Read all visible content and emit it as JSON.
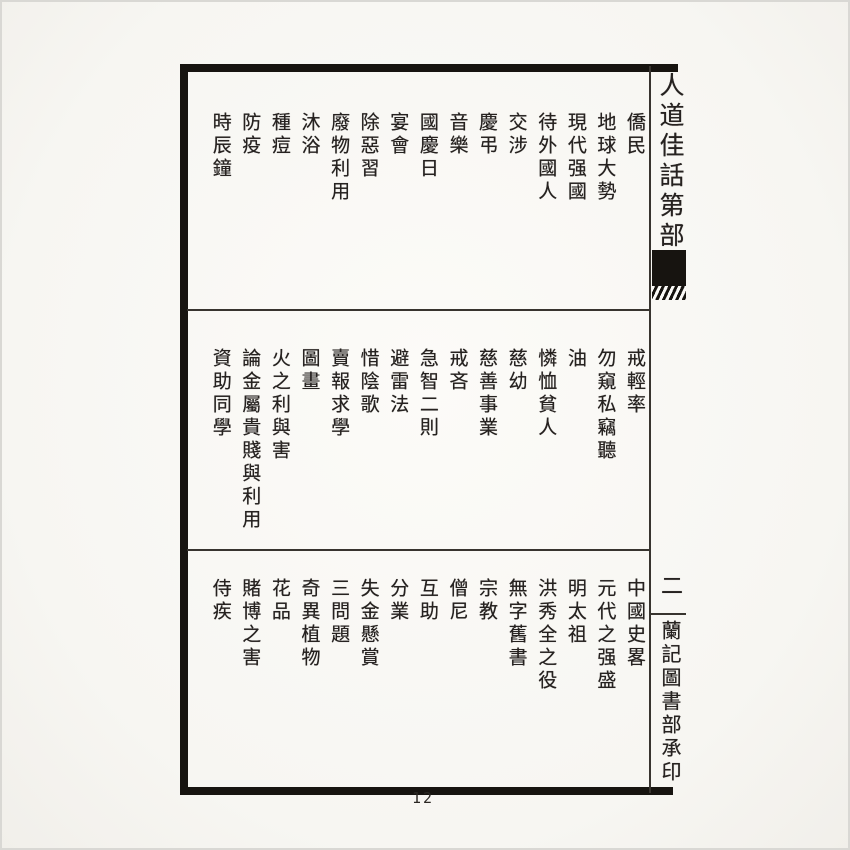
{
  "page": {
    "number": "12",
    "spine": {
      "title": "人道佳話第部",
      "volume": "二",
      "publisher": "蘭記圖書部承印"
    },
    "sections": [
      {
        "name": "top",
        "entries": [
          "僑民",
          "地球大勢",
          "現代强國",
          "待外國人",
          "交涉",
          "慶弔",
          "音樂",
          "國慶日",
          "宴會",
          "除惡習",
          "廢物利用",
          "沐浴",
          "種痘",
          "防疫",
          "時辰鐘"
        ]
      },
      {
        "name": "middle",
        "entries": [
          "戒輕率",
          "勿窺私竊聽",
          "油",
          "憐恤貧人",
          "慈幼",
          "慈善事業",
          "戒吝",
          "急智二則",
          "避雷法",
          "惜陰歌",
          "賣報求學",
          "圖畫",
          "火之利與害",
          "論金屬貴賤與利用",
          "資助同學"
        ]
      },
      {
        "name": "bottom",
        "entries": [
          "中國史畧",
          "元代之强盛",
          "明太祖",
          "洪秀全之役",
          "無字舊書",
          "宗教",
          "僧尼",
          "互助",
          "分業",
          "失金懸賞",
          "三問題",
          "奇異植物",
          "花品",
          "賭博之害",
          "侍疾"
        ]
      }
    ]
  }
}
